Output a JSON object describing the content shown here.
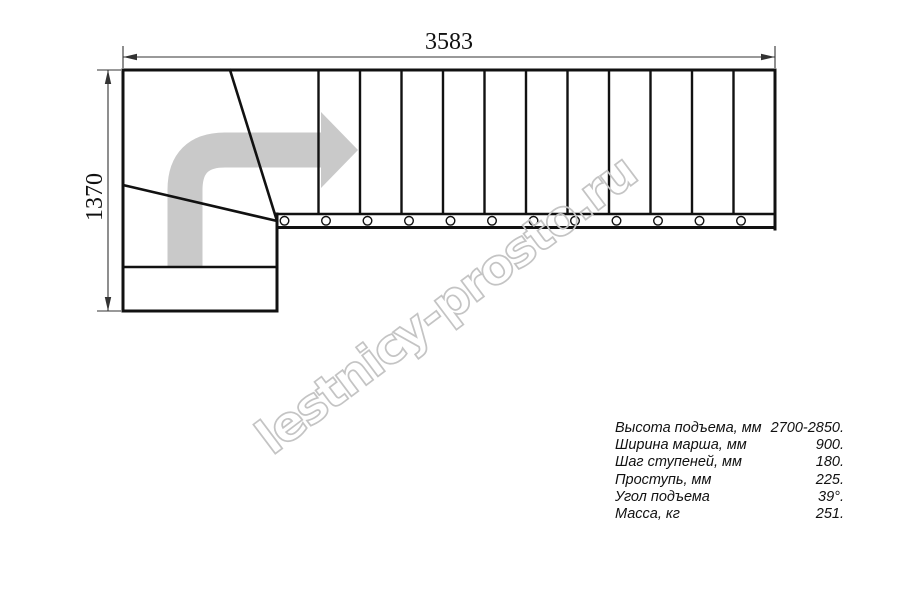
{
  "drawing": {
    "title": "staircase-plan",
    "dimensions": {
      "width_label": "3583",
      "height_label": "1370"
    },
    "steps_shown": 12
  },
  "watermark": {
    "text": "lestnicy-prosto.ru"
  },
  "specs": {
    "rows": [
      {
        "label": "Высота подъема, мм",
        "value": "2700-2850."
      },
      {
        "label": "Ширина марша, мм",
        "value": "900."
      },
      {
        "label": "Шаг ступеней, мм",
        "value": "180."
      },
      {
        "label": "Проступь, мм",
        "value": "225."
      },
      {
        "label": "Угол подъема",
        "value": "39°."
      },
      {
        "label": "Масса, кг",
        "value": "251."
      }
    ]
  },
  "colors": {
    "line": "#111111",
    "dimension_line": "#333333",
    "arrow_fill": "#c9c9c9",
    "watermark_outline": "#c4c4c4",
    "background": "#ffffff"
  }
}
